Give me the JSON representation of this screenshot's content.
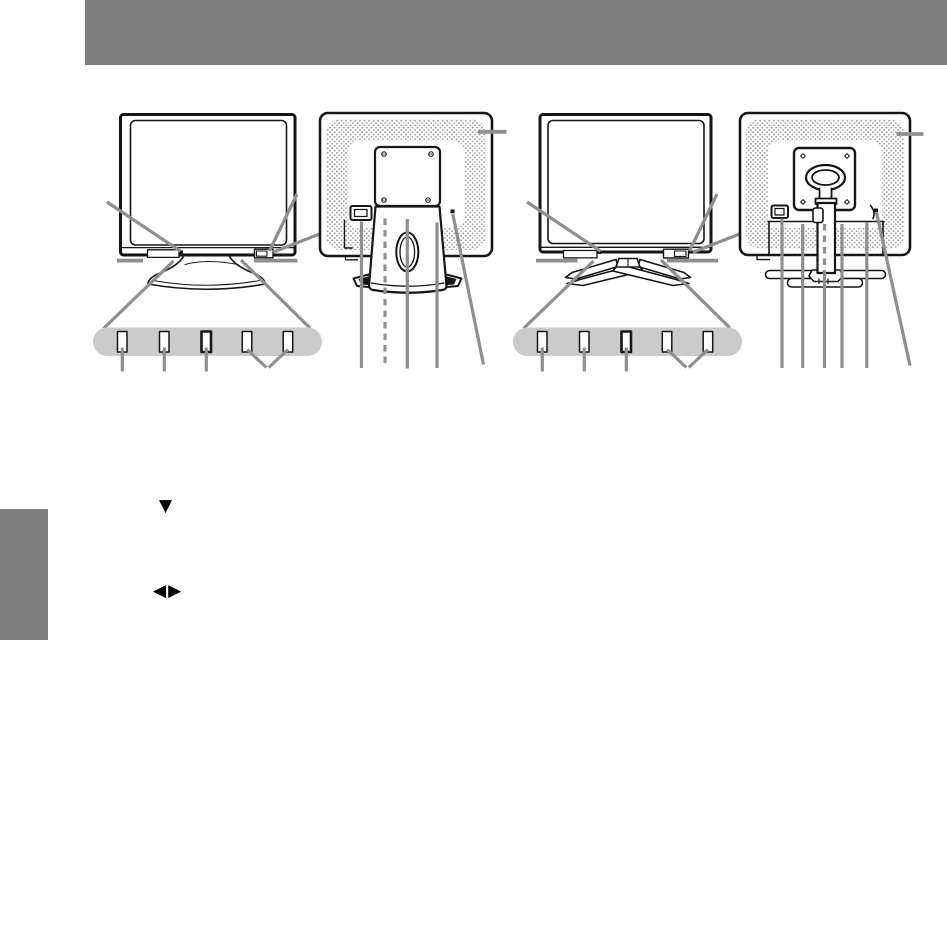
{
  "document": {
    "kind": "monitor-manual-page",
    "header_bar_text": "",
    "side_tab_text": ""
  },
  "symbols": {
    "down_triangle": "▼",
    "left_right_triangles": "◀▶"
  },
  "colors": {
    "page_bg": "#ffffff",
    "header_gray": "#7f7f7f",
    "line": "#161616",
    "leader": "#8f8f8f",
    "pill": "#cbcbcb",
    "stipple": "#9a9a9a"
  },
  "figures": [
    {
      "name": "monitor-1-front-view",
      "features": [
        "power-indicator",
        "power-button",
        "control-buttons"
      ]
    },
    {
      "name": "monitor-1-rear-view",
      "features": [
        "vent-holes",
        "power-connector",
        "stand-handle-hole",
        "lock-slot"
      ]
    },
    {
      "name": "monitor-2-front-view",
      "features": [
        "power-indicator",
        "power-button",
        "control-buttons"
      ]
    },
    {
      "name": "monitor-2-rear-view",
      "features": [
        "vent-holes",
        "power-connector",
        "stand-column",
        "lock-slot"
      ]
    }
  ]
}
